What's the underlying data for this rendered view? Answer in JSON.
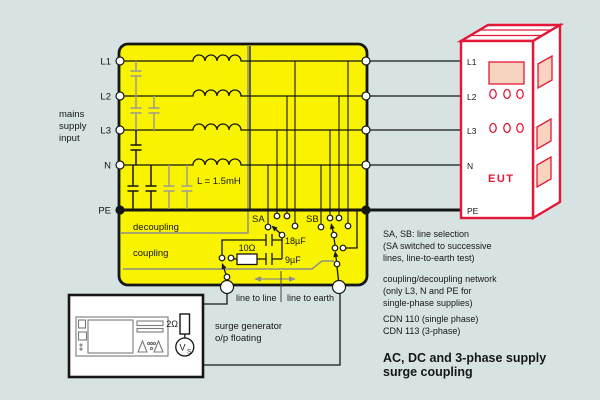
{
  "colors": {
    "background": "#d7e3e3",
    "network_fill": "#f9f300",
    "eut_red": "#e31837",
    "eut_panel": "#f7d4c0",
    "frame_gray": "#8e8e8e",
    "wire_black": "#161616"
  },
  "mains": {
    "caption": [
      "mains",
      "supply",
      "input"
    ],
    "lines": [
      "L1",
      "L2",
      "L3",
      "N",
      "PE"
    ]
  },
  "cdn": {
    "decoupling_label": "decoupling",
    "coupling_label": "coupling",
    "inductor_value": "L = 1.5mH",
    "switch_a": "SA",
    "switch_b": "SB",
    "resistor_value": "10Ω",
    "cap_line_value": "18µF",
    "cap_earth_value": "9µF",
    "mode_left": "line to line",
    "mode_right": "line to earth"
  },
  "eut": {
    "name": "EUT",
    "ports": [
      "L1",
      "L2",
      "L3",
      "N",
      "PE"
    ]
  },
  "generator": {
    "impedance": "2Ω",
    "source_main": "V",
    "source_sub": "S",
    "caption": [
      "surge generator",
      "o/p floating"
    ]
  },
  "notes": {
    "sa_sb": [
      "SA, SB: line selection",
      "(SA switched to successive",
      "lines, line-to-earth test)"
    ],
    "cdn": [
      "coupling/decoupling network",
      "(only L3, N and PE for",
      "single-phase supplies)"
    ],
    "models": [
      "CDN 110 (single phase)",
      "CDN 113 (3-phase)"
    ],
    "title": [
      "AC, DC and 3-phase supply",
      "surge coupling"
    ]
  }
}
